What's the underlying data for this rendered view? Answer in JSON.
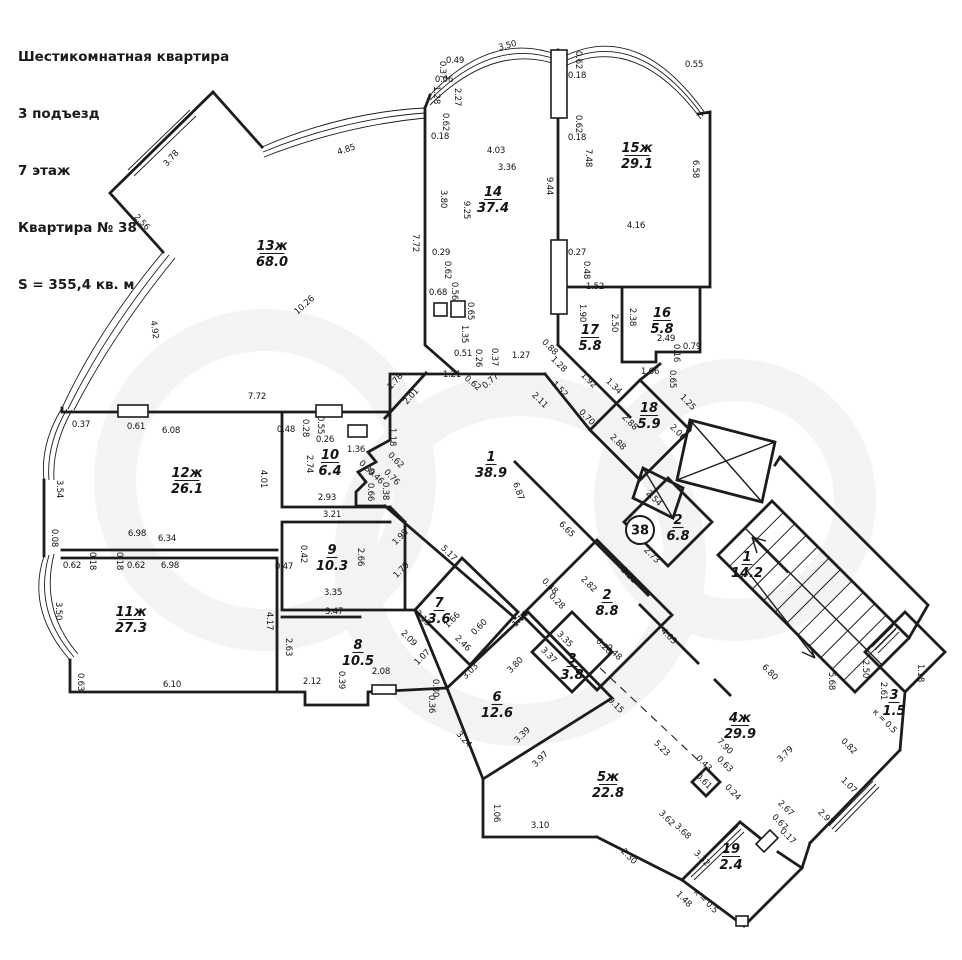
{
  "header": {
    "lines": [
      "Шестикомнатная квартира",
      "3 подъезд",
      "7 этаж",
      "Квартира № 38",
      "S = 355,4 кв. м"
    ]
  },
  "plan": {
    "ink": "#1c1c1c",
    "badge": {
      "text": "38",
      "x": 640,
      "y": 530
    },
    "rooms": [
      {
        "num": "13ж",
        "area": "68.0",
        "x": 272,
        "y": 250
      },
      {
        "num": "14",
        "area": "37.4",
        "x": 493,
        "y": 196
      },
      {
        "num": "15ж",
        "area": "29.1",
        "x": 637,
        "y": 152
      },
      {
        "num": "16",
        "area": "5.8",
        "x": 662,
        "y": 317
      },
      {
        "num": "17",
        "area": "5.8",
        "x": 590,
        "y": 334
      },
      {
        "num": "18",
        "area": "5.9",
        "x": 649,
        "y": 412
      },
      {
        "num": "1",
        "area": "38.9",
        "x": 491,
        "y": 461
      },
      {
        "num": "12ж",
        "area": "26.1",
        "x": 187,
        "y": 477
      },
      {
        "num": "10",
        "area": "6.4",
        "x": 330,
        "y": 459
      },
      {
        "num": "9",
        "area": "10.3",
        "x": 332,
        "y": 554
      },
      {
        "num": "11ж",
        "area": "27.3",
        "x": 131,
        "y": 616
      },
      {
        "num": "8",
        "area": "10.5",
        "x": 358,
        "y": 649
      },
      {
        "num": "7",
        "area": "3.6",
        "x": 439,
        "y": 607
      },
      {
        "num": "6",
        "area": "12.6",
        "x": 497,
        "y": 701
      },
      {
        "num": "3",
        "area": "3.8",
        "x": 572,
        "y": 663
      },
      {
        "num": "2",
        "area": "8.8",
        "x": 607,
        "y": 599
      },
      {
        "num": "2",
        "area": "6.8",
        "x": 678,
        "y": 524
      },
      {
        "num": "1",
        "area": "14.2",
        "x": 747,
        "y": 561
      },
      {
        "num": "4ж",
        "area": "29.9",
        "x": 740,
        "y": 722
      },
      {
        "num": "5ж",
        "area": "22.8",
        "x": 608,
        "y": 781
      },
      {
        "num": "19",
        "area": "2.4",
        "x": 731,
        "y": 853
      },
      {
        "num": "3",
        "area": "1.5",
        "x": 894,
        "y": 699
      }
    ],
    "dims": [
      [
        "3.78",
        173,
        160,
        -48
      ],
      [
        "2.56",
        140,
        224,
        46
      ],
      [
        "4.92",
        152,
        330,
        82
      ],
      [
        "4.85",
        347,
        152,
        -18
      ],
      [
        "10.26",
        306,
        307,
        -42
      ],
      [
        "3.50",
        508,
        48,
        -14
      ],
      [
        "0.49",
        455,
        63,
        0
      ],
      [
        "0.37",
        440,
        70,
        90
      ],
      [
        "0.06",
        444,
        82,
        0
      ],
      [
        "1.28",
        434,
        95,
        90
      ],
      [
        "2.27",
        455,
        97,
        90
      ],
      [
        "0.62",
        443,
        122,
        90
      ],
      [
        "0.18",
        440,
        139,
        0
      ],
      [
        "4.03",
        496,
        153,
        0
      ],
      [
        "3.36",
        507,
        170,
        0
      ],
      [
        "9.44",
        547,
        186,
        90
      ],
      [
        "3.80",
        441,
        199,
        90
      ],
      [
        "9.25",
        464,
        210,
        90
      ],
      [
        "7.72",
        413,
        243,
        90
      ],
      [
        "0.29",
        441,
        255,
        0
      ],
      [
        "0.62",
        445,
        270,
        90
      ],
      [
        "0.68",
        438,
        295,
        0
      ],
      [
        "0.56",
        452,
        291,
        90
      ],
      [
        "0.65",
        468,
        311,
        90
      ],
      [
        "1.35",
        462,
        334,
        90
      ],
      [
        "0.51",
        463,
        356,
        0
      ],
      [
        "0.26",
        476,
        358,
        90
      ],
      [
        "0.37",
        492,
        357,
        90
      ],
      [
        "1.27",
        521,
        358,
        0
      ],
      [
        "0.62",
        576,
        60,
        90
      ],
      [
        "0.18",
        577,
        78,
        0
      ],
      [
        "0.55",
        694,
        67,
        0
      ],
      [
        "0.62",
        576,
        124,
        90
      ],
      [
        "0.18",
        577,
        140,
        0
      ],
      [
        "7.48",
        586,
        158,
        90
      ],
      [
        "6.58",
        693,
        169,
        90
      ],
      [
        "4.16",
        636,
        228,
        0
      ],
      [
        "0.27",
        577,
        255,
        0
      ],
      [
        "0.48",
        584,
        270,
        90
      ],
      [
        "1.52",
        595,
        289,
        0
      ],
      [
        "1.90",
        580,
        313,
        90
      ],
      [
        "2.50",
        612,
        323,
        90
      ],
      [
        "2.38",
        630,
        317,
        90
      ],
      [
        "2.49",
        666,
        341,
        0
      ],
      [
        "0.16",
        674,
        353,
        90
      ],
      [
        "0.79",
        692,
        349,
        0
      ],
      [
        "1.66",
        650,
        374,
        0
      ],
      [
        "0.65",
        670,
        379,
        90
      ],
      [
        "1.34",
        612,
        388,
        45
      ],
      [
        "1.92",
        587,
        382,
        45
      ],
      [
        "1.28",
        557,
        366,
        45
      ],
      [
        "0.88",
        548,
        349,
        45
      ],
      [
        "1.52",
        558,
        391,
        45
      ],
      [
        "1.25",
        686,
        404,
        45
      ],
      [
        "2.06",
        676,
        434,
        45
      ],
      [
        "0.70",
        585,
        419,
        45
      ],
      [
        "2.88",
        628,
        424,
        45
      ],
      [
        "2.88",
        616,
        444,
        45
      ],
      [
        "2.54",
        652,
        500,
        45
      ],
      [
        "1.78",
        397,
        383,
        -48
      ],
      [
        "2.01",
        413,
        398,
        -48
      ],
      [
        "1.21",
        452,
        377,
        0
      ],
      [
        "0.62",
        471,
        385,
        40
      ],
      [
        "0.77",
        492,
        383,
        -40
      ],
      [
        "2.11",
        538,
        402,
        45
      ],
      [
        "6.87",
        516,
        492,
        70
      ],
      [
        "6.65",
        565,
        531,
        45
      ],
      [
        "1.18",
        390,
        437,
        90
      ],
      [
        "0.62",
        394,
        462,
        45
      ],
      [
        "0.39",
        365,
        470,
        45
      ],
      [
        "0.46",
        374,
        478,
        45
      ],
      [
        "0.76",
        390,
        479,
        45
      ],
      [
        "0.66",
        368,
        492,
        90
      ],
      [
        "0.38",
        383,
        491,
        90
      ],
      [
        "7.72",
        257,
        399,
        0
      ],
      [
        "0.37",
        81,
        427,
        0
      ],
      [
        "0.61",
        136,
        429,
        0
      ],
      [
        "6.08",
        171,
        433,
        0
      ],
      [
        "0.48",
        286,
        432,
        0
      ],
      [
        "0.28",
        303,
        428,
        90
      ],
      [
        "0.55",
        318,
        425,
        90
      ],
      [
        "0.26",
        325,
        442,
        0
      ],
      [
        "1.36",
        356,
        452,
        0
      ],
      [
        "2.74",
        307,
        464,
        90
      ],
      [
        "4.01",
        261,
        479,
        90
      ],
      [
        "3.54",
        57,
        489,
        90
      ],
      [
        "0.08",
        52,
        538,
        90
      ],
      [
        "6.98",
        137,
        536,
        0
      ],
      [
        "6.34",
        167,
        541,
        0
      ],
      [
        "2.93",
        327,
        500,
        0
      ],
      [
        "3.21",
        332,
        517,
        0
      ],
      [
        "0.62",
        72,
        568,
        0
      ],
      [
        "0.18",
        90,
        561,
        90
      ],
      [
        "0.18",
        117,
        561,
        90
      ],
      [
        "0.62",
        136,
        568,
        0
      ],
      [
        "6.98",
        170,
        568,
        0
      ],
      [
        "0.42",
        301,
        554,
        90
      ],
      [
        "0.47",
        284,
        569,
        0
      ],
      [
        "2.66",
        358,
        557,
        90
      ],
      [
        "3.50",
        56,
        611,
        90
      ],
      [
        "0.63",
        78,
        682,
        90
      ],
      [
        "6.10",
        172,
        687,
        0
      ],
      [
        "4.17",
        267,
        621,
        90
      ],
      [
        "2.63",
        286,
        647,
        90
      ],
      [
        "2.12",
        312,
        684,
        0
      ],
      [
        "0.39",
        339,
        680,
        90
      ],
      [
        "2.08",
        381,
        674,
        0
      ],
      [
        "3.35",
        333,
        595,
        0
      ],
      [
        "3.47",
        334,
        614,
        0
      ],
      [
        "1.98",
        402,
        539,
        -45
      ],
      [
        "5.17",
        447,
        555,
        45
      ],
      [
        "1.79",
        403,
        572,
        -45
      ],
      [
        "2.15",
        421,
        620,
        45
      ],
      [
        "2.09",
        407,
        640,
        45
      ],
      [
        "1.66",
        454,
        622,
        -45
      ],
      [
        "0.60",
        481,
        629,
        -45
      ],
      [
        "2.46",
        461,
        645,
        45
      ],
      [
        "1.07",
        424,
        659,
        -45
      ],
      [
        "3.03",
        472,
        673,
        -45
      ],
      [
        "3.80",
        517,
        667,
        -45
      ],
      [
        "0.80",
        433,
        688,
        90
      ],
      [
        "0.36",
        429,
        704,
        90
      ],
      [
        "3.24",
        462,
        741,
        48
      ],
      [
        "3.39",
        524,
        737,
        -45
      ],
      [
        "3.97",
        542,
        761,
        -45
      ],
      [
        "1.14",
        522,
        621,
        -45
      ],
      [
        "3.35",
        563,
        641,
        45
      ],
      [
        "3.37",
        547,
        657,
        45
      ],
      [
        "2.82",
        587,
        586,
        45
      ],
      [
        "0.48",
        548,
        588,
        45
      ],
      [
        "0.28",
        555,
        603,
        45
      ],
      [
        "0.28",
        602,
        648,
        45
      ],
      [
        "0.48",
        612,
        654,
        45
      ],
      [
        "3.21",
        627,
        577,
        45
      ],
      [
        "2.73",
        650,
        557,
        45
      ],
      [
        "4.03",
        667,
        638,
        45
      ],
      [
        "9.15",
        614,
        707,
        45
      ],
      [
        "1.06",
        494,
        813,
        90
      ],
      [
        "3.10",
        540,
        828,
        0
      ],
      [
        "2.30",
        627,
        858,
        45
      ],
      [
        "3.62",
        665,
        820,
        45
      ],
      [
        "3.68",
        681,
        833,
        45
      ],
      [
        "3.32",
        700,
        860,
        45
      ],
      [
        "1.48",
        682,
        901,
        45
      ],
      [
        "к = 0.5",
        704,
        903,
        45
      ],
      [
        "5.23",
        660,
        750,
        45
      ],
      [
        "7.90",
        723,
        748,
        45
      ],
      [
        "0.43",
        702,
        765,
        45
      ],
      [
        "0.63",
        723,
        766,
        45
      ],
      [
        "0.61",
        702,
        783,
        45
      ],
      [
        "0.24",
        731,
        794,
        45
      ],
      [
        "3.79",
        787,
        756,
        -45
      ],
      [
        "2.67",
        784,
        810,
        45
      ],
      [
        "0.67",
        778,
        824,
        45
      ],
      [
        "0.17",
        786,
        838,
        45
      ],
      [
        "6.80",
        768,
        674,
        45
      ],
      [
        "5.68",
        829,
        681,
        90
      ],
      [
        "2.50",
        863,
        669,
        90
      ],
      [
        "2.61",
        881,
        691,
        90
      ],
      [
        "1.18",
        918,
        673,
        90
      ],
      [
        "0.82",
        847,
        748,
        45
      ],
      [
        "1.07",
        847,
        787,
        45
      ],
      [
        "2.97",
        824,
        819,
        45
      ],
      [
        "к = 0.5",
        883,
        723,
        45
      ]
    ]
  }
}
